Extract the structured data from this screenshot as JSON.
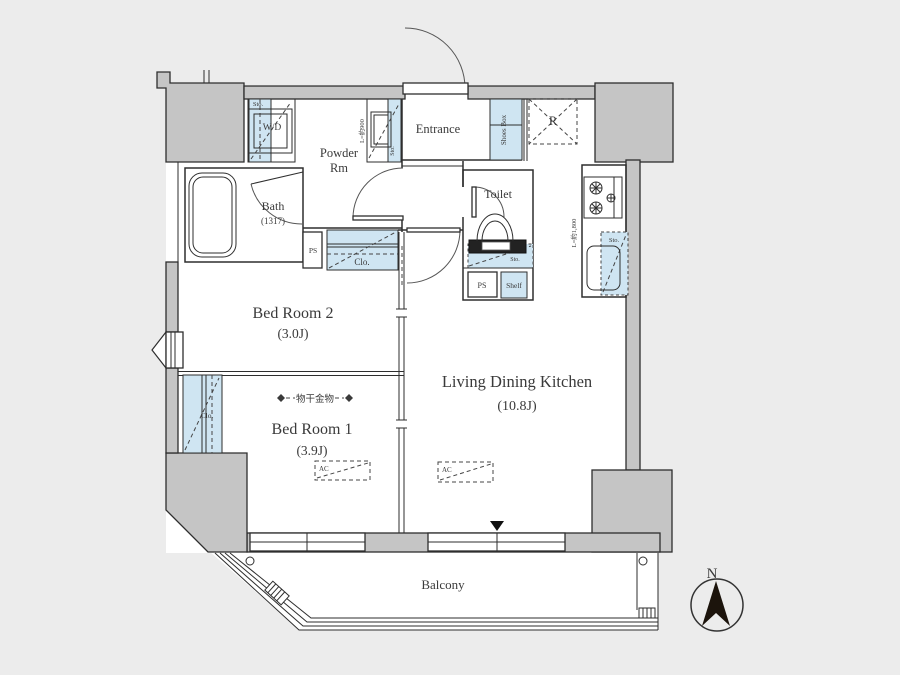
{
  "colors": {
    "background": "#ececec",
    "wall_fill": "#c5c5c5",
    "storage_fill": "#cfe5f2",
    "line": "#2e2e2e",
    "text": "#3a3a3a"
  },
  "rooms": {
    "bedroom2": {
      "name": "Bed Room 2",
      "size": "(3.0J)"
    },
    "bedroom1": {
      "name": "Bed Room 1",
      "size": "(3.9J)"
    },
    "ldk": {
      "name": "Living Dining Kitchen",
      "size": "(10.8J)"
    },
    "bath": {
      "name": "Bath",
      "size": "(1317)"
    },
    "powder": {
      "line1": "Powder",
      "line2": "Rm"
    },
    "toilet": "Toilet",
    "entrance": "Entrance",
    "balcony": "Balcony"
  },
  "fixtures": {
    "washer_dryer": "W/D",
    "shoes_box": "Shoes Box",
    "refrigerator": "R",
    "pipe_space": "PS",
    "shelf": "Shelf",
    "closet": "Clo.",
    "storage": "Sto.",
    "air_conditioner": "AC",
    "laundry_hardware": "物干金物",
    "vanity_length": "L=約900",
    "kitchen_length": "L=約1,800"
  },
  "compass": {
    "north": "N"
  }
}
